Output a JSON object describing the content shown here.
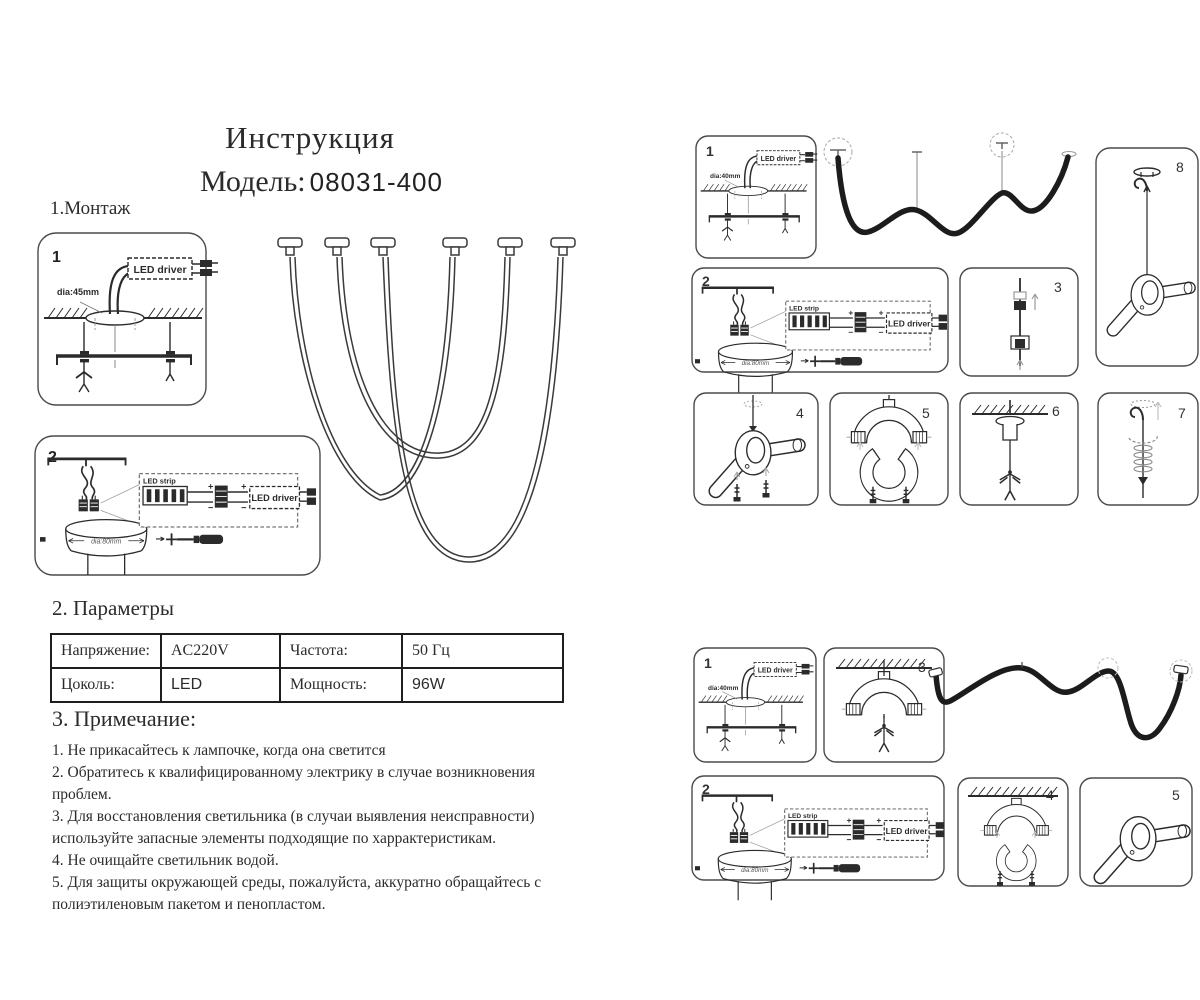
{
  "header": {
    "title": "Инструкция",
    "model_label": "Модель:",
    "model_number": "08031-400"
  },
  "sections": {
    "montage": "1.Монтаж",
    "parameters": "2. Параметры",
    "notes_title": "3. Примечание:"
  },
  "table": {
    "rows": [
      [
        "Напряжение:",
        "AC220V",
        "Частота:",
        "50 Гц"
      ],
      [
        "Цоколь:",
        "LED",
        "Мощность:",
        "96W"
      ]
    ]
  },
  "notes": [
    "1. Не прикасайтесь к лампочке, когда она светится",
    "2. Обратитесь к квалифицированному электрику в случае возникновения проблем.",
    "3. Для восстановления светильника (в случаи выявления неисправности) используйте запасные элементы подходящие по харрактеристикам.",
    "4. Не очищайте  светильник водой.",
    "5. Для защиты окружающей среды, пожалуйста, аккуратно обращайтесь с полиэтиленовым пакетом и пенопластом."
  ],
  "labels": {
    "led_driver": "LED driver",
    "led_strip": "LED strip",
    "dia_45": "dia:45mm",
    "dia_40": "dia:40mm",
    "dia_80": "dia:80mm"
  },
  "panels": {
    "l1": "1",
    "l2": "2",
    "r1": "1",
    "r2": "2",
    "r3": "3",
    "r4": "4",
    "r5": "5",
    "r6": "6",
    "r7": "7",
    "r8": "8",
    "b1": "1",
    "b2": "2",
    "b3": "3",
    "b4": "4",
    "b5": "5"
  },
  "colors": {
    "ink": "#2b2b2b",
    "gray": "#9a9a9a"
  }
}
